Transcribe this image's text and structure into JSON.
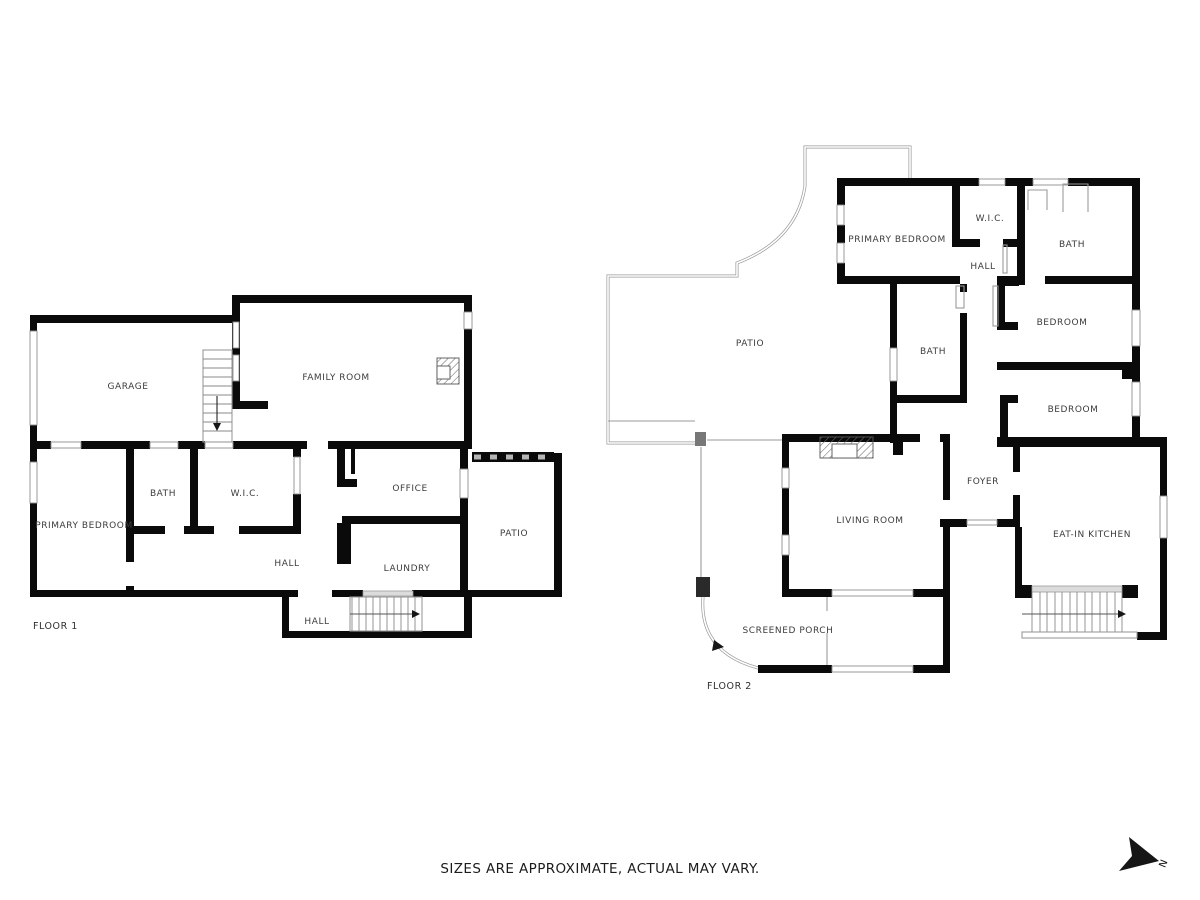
{
  "floor1": {
    "label": "FLOOR 1",
    "rooms": {
      "garage": "GARAGE",
      "family_room": "FAMILY ROOM",
      "primary_bedroom": "PRIMARY BEDROOM",
      "bath": "BATH",
      "wic": "W.I.C.",
      "office": "OFFICE",
      "hall": "HALL",
      "laundry": "LAUNDRY",
      "hall_lower": "HALL",
      "patio": "PATIO"
    }
  },
  "floor2": {
    "label": "FLOOR 2",
    "rooms": {
      "patio": "PATIO",
      "primary_bedroom": "PRIMARY BEDROOM",
      "wic": "W.I.C.",
      "bath_upper": "BATH",
      "hall": "HALL",
      "bath_middle": "BATH",
      "bedroom_upper": "BEDROOM",
      "bedroom_lower": "BEDROOM",
      "foyer": "FOYER",
      "eat_in_kitchen": "EAT-IN KITCHEN",
      "living_room": "LIVING ROOM",
      "screened_porch": "SCREENED PORCH"
    }
  },
  "footer": {
    "disclaimer": "SIZES ARE APPROXIMATE, ACTUAL MAY VARY."
  },
  "compass": {
    "north_label": "N"
  },
  "colors": {
    "background": "#ffffff",
    "wall": "#0a0a0a",
    "thin_line": "#9a9a9a",
    "label_text": "#3c3c3c"
  }
}
